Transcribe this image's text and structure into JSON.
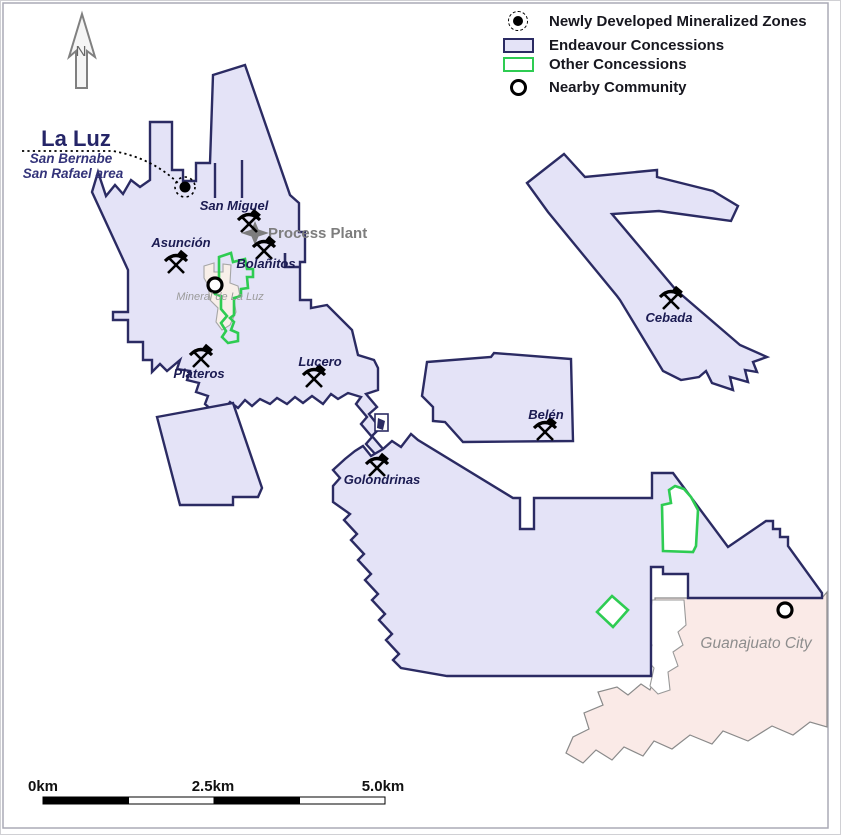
{
  "legend": {
    "items": [
      {
        "label": "Newly Developed Mineralized Zones"
      },
      {
        "label": "Endeavour Concessions"
      },
      {
        "label": "Other Concessions"
      },
      {
        "label": "Nearby Community"
      }
    ]
  },
  "title": {
    "name": "La Luz",
    "sub1": "San Bernabe",
    "sub2": "San Rafael area"
  },
  "north_label": "N",
  "process_plant_label": "Process Plant",
  "mines": {
    "san_miguel": "San Miguel",
    "asuncion": "Asunción",
    "bolanitos": "Bolañitos",
    "plateros": "Plateros",
    "lucero": "Lucero",
    "cebada": "Cebada",
    "belen": "Belén",
    "golondrinas": "Golondrinas"
  },
  "communities": {
    "mineral_de_la_luz": "Mineral de La Luz",
    "guanajuato_city": "Guanajuato City"
  },
  "scale_bar": {
    "start": "0km",
    "mid": "2.5km",
    "end": "5.0km"
  },
  "colors": {
    "endeavour_fill": "#e4e3f7",
    "endeavour_border": "#2b2b63",
    "other_concession": "#2ecc52",
    "city_fill": "#faeae7",
    "city_outline": "#8a8a8a",
    "mineralized_zone": "#000000"
  }
}
